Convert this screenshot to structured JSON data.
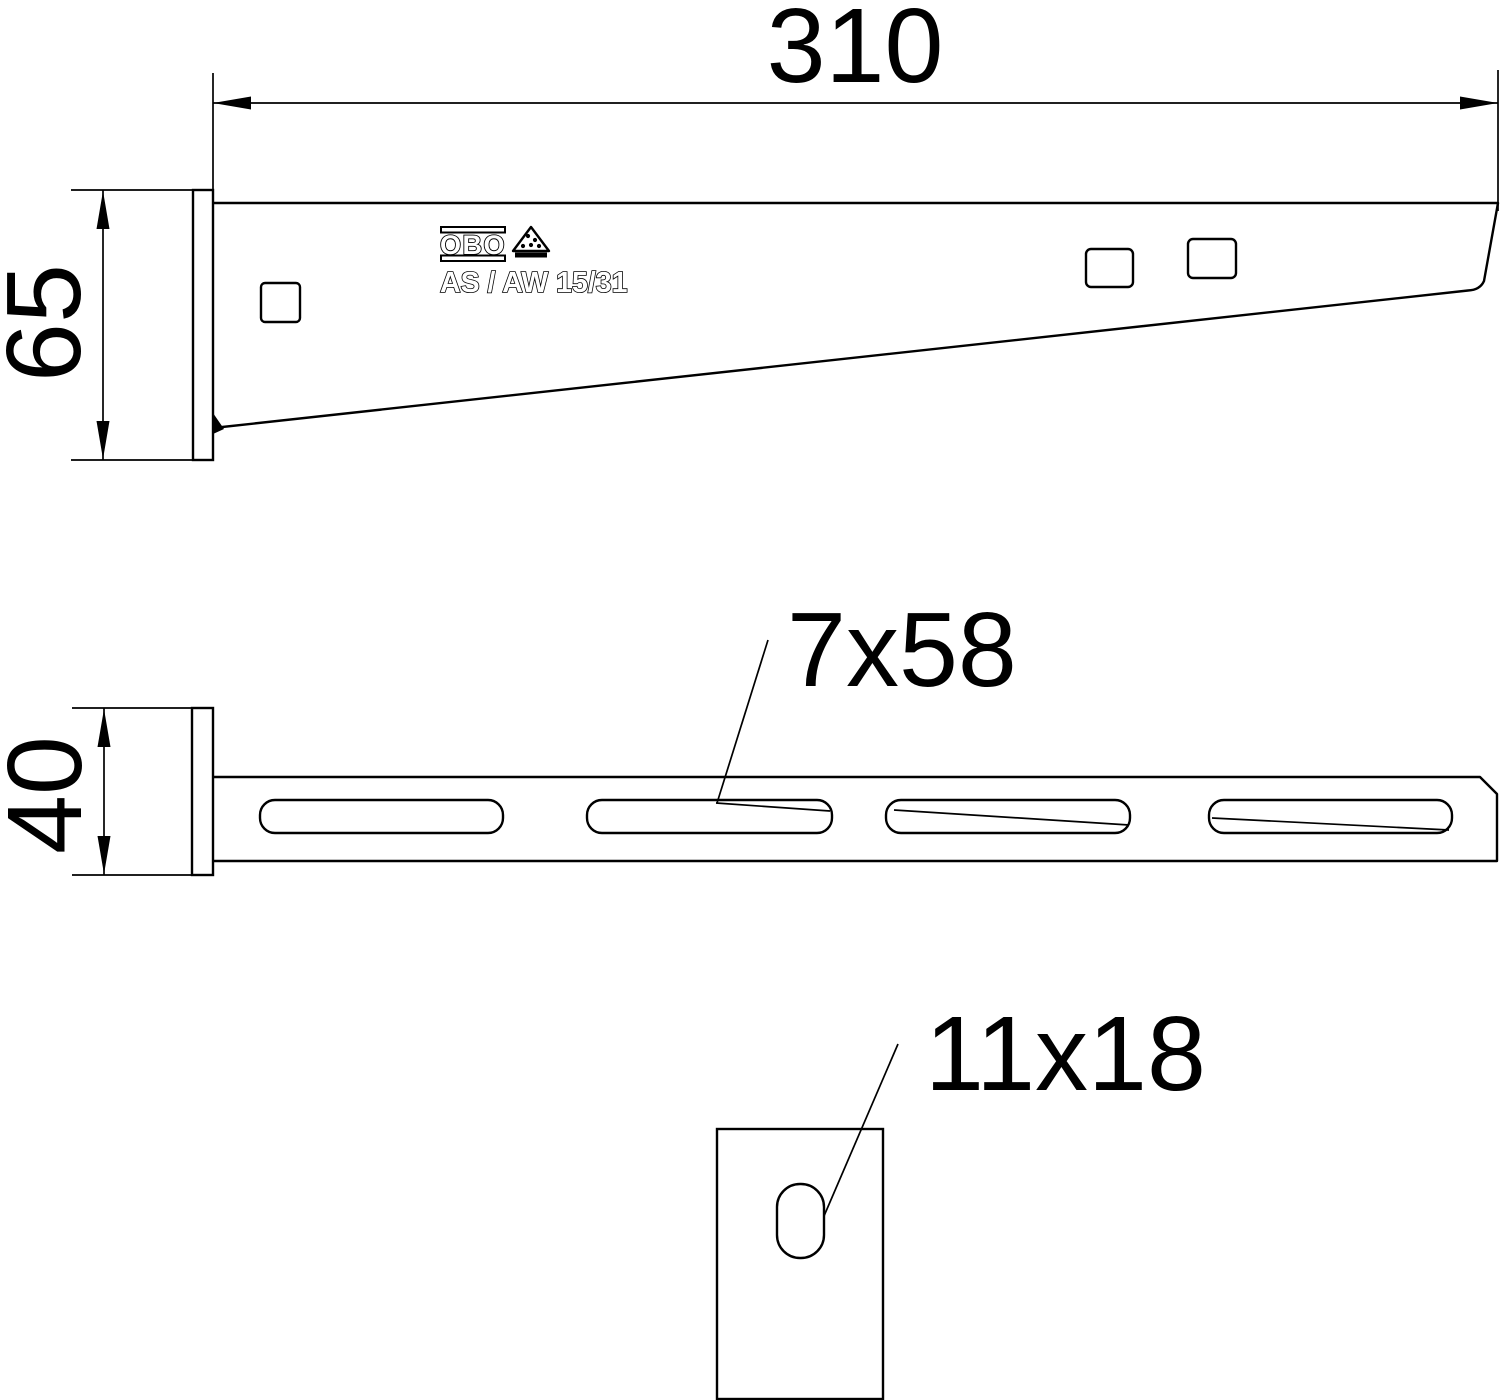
{
  "colors": {
    "line": "#000000",
    "background": "#ffffff"
  },
  "views": {
    "side": {
      "width_dim": "310",
      "height_dim": "65",
      "logo": "OBO",
      "marking": "AS / AW 15/31"
    },
    "plan": {
      "width_dim": "40",
      "slot_dim": "7x58"
    },
    "front": {
      "hole_dim": "11x18"
    }
  }
}
